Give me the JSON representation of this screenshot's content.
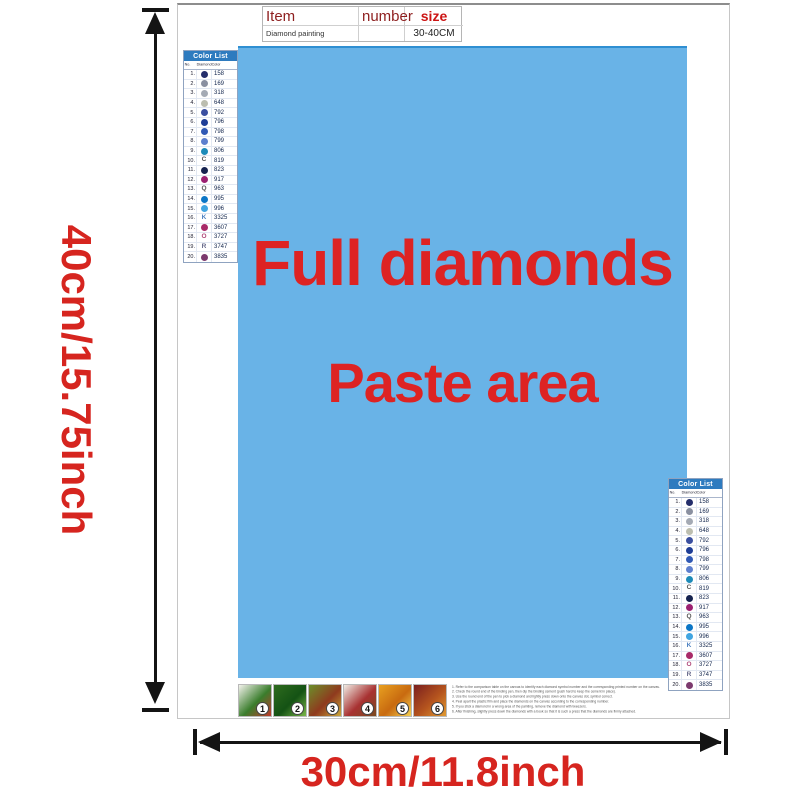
{
  "labels": {
    "height": "40cm/15.75inch",
    "width": "30cm/11.8inch",
    "full_diamonds": "Full diamonds",
    "paste_area": "Paste area"
  },
  "item_table": {
    "col_item": "Item",
    "col_number": "number",
    "col_size": "size",
    "product_name": "Diamond painting",
    "product_number": "",
    "product_size": "30-40CM"
  },
  "color_list": {
    "title": "Color List",
    "headers": [
      "No.",
      "Diamond",
      "Color"
    ],
    "rows": [
      {
        "no": "1",
        "symbol": "dot",
        "dot_color": "#232d6b",
        "letter": "",
        "code": "158"
      },
      {
        "no": "2",
        "symbol": "dot",
        "dot_color": "#8a90a0",
        "letter": "",
        "code": "169"
      },
      {
        "no": "3",
        "symbol": "dot",
        "dot_color": "#a4aab4",
        "letter": "",
        "code": "318"
      },
      {
        "no": "4",
        "symbol": "dot",
        "dot_color": "#bcbeb0",
        "letter": "",
        "code": "648"
      },
      {
        "no": "5",
        "symbol": "dot",
        "dot_color": "#3a4fa0",
        "letter": "",
        "code": "792"
      },
      {
        "no": "6",
        "symbol": "dot",
        "dot_color": "#1e3d96",
        "letter": "",
        "code": "796"
      },
      {
        "no": "7",
        "symbol": "dot",
        "dot_color": "#3059b5",
        "letter": "",
        "code": "798"
      },
      {
        "no": "8",
        "symbol": "dot",
        "dot_color": "#5d7fce",
        "letter": "",
        "code": "799"
      },
      {
        "no": "9",
        "symbol": "dot",
        "dot_color": "#1d8bb8",
        "letter": "",
        "code": "806"
      },
      {
        "no": "10",
        "symbol": "letter",
        "dot_color": "",
        "letter": "C",
        "letter_color": "#555555",
        "code": "819"
      },
      {
        "no": "11",
        "symbol": "dot",
        "dot_color": "#15224f",
        "letter": "",
        "code": "823"
      },
      {
        "no": "12",
        "symbol": "dot",
        "dot_color": "#9b2071",
        "letter": "",
        "code": "917"
      },
      {
        "no": "13",
        "symbol": "letter",
        "dot_color": "",
        "letter": "Q",
        "letter_color": "#555555",
        "code": "963"
      },
      {
        "no": "14",
        "symbol": "dot",
        "dot_color": "#0c76c6",
        "letter": "",
        "code": "995"
      },
      {
        "no": "15",
        "symbol": "dot",
        "dot_color": "#41a5e1",
        "letter": "",
        "code": "996"
      },
      {
        "no": "16",
        "symbol": "letter",
        "dot_color": "",
        "letter": "K",
        "letter_color": "#4a7fc0",
        "code": "3325"
      },
      {
        "no": "17",
        "symbol": "dot",
        "dot_color": "#a82a68",
        "letter": "",
        "code": "3607"
      },
      {
        "no": "18",
        "symbol": "letter",
        "dot_color": "",
        "letter": "O",
        "letter_color": "#b04a7a",
        "code": "3727"
      },
      {
        "no": "19",
        "symbol": "letter",
        "dot_color": "",
        "letter": "R",
        "letter_color": "#66688a",
        "code": "3747"
      },
      {
        "no": "20",
        "symbol": "dot",
        "dot_color": "#7c3a6e",
        "letter": "",
        "code": "3835"
      }
    ]
  },
  "steps": [
    {
      "number": "1",
      "palette": [
        "#f3f2ec",
        "#3a7d2c",
        "#c0392b"
      ]
    },
    {
      "number": "2",
      "palette": [
        "#2e6b1e",
        "#145214",
        "#7ab648"
      ]
    },
    {
      "number": "3",
      "palette": [
        "#6b8f2a",
        "#8f3a1e",
        "#caa83a"
      ]
    },
    {
      "number": "4",
      "palette": [
        "#f0ece4",
        "#a83232",
        "#7a4a1e"
      ]
    },
    {
      "number": "5",
      "palette": [
        "#e8a020",
        "#c86a10",
        "#f5d050"
      ]
    },
    {
      "number": "6",
      "palette": [
        "#7a1f1f",
        "#b5541e",
        "#e09a30"
      ]
    }
  ],
  "instructions": [
    "1. Refer to the comparison table on the canvas to identify each diamond symbol number and the corresponding printed number on the canvas.",
    "2. Check the round end of the binding pen, then dip the binding cement (push hard to keep the cement in place).",
    "3. Use the round end of the pen to pick a diamond and lightly press down onto the canvas dot, symbol correct.",
    "4. Peel apart the plastic film and place the diamonds on the canvas according to the corresponding number.",
    "5. If you stick a diamond in a wrong area of the painting, remove the diamond with tweezers.",
    "6. After finishing, slightly press down the diamonds with a book so that it is such a press that the diamonds are firmly attached."
  ],
  "colors": {
    "paste_area_blue": "#69b3e7",
    "accent_red": "#d6251f",
    "list_header_blue": "#2e7bbf"
  }
}
